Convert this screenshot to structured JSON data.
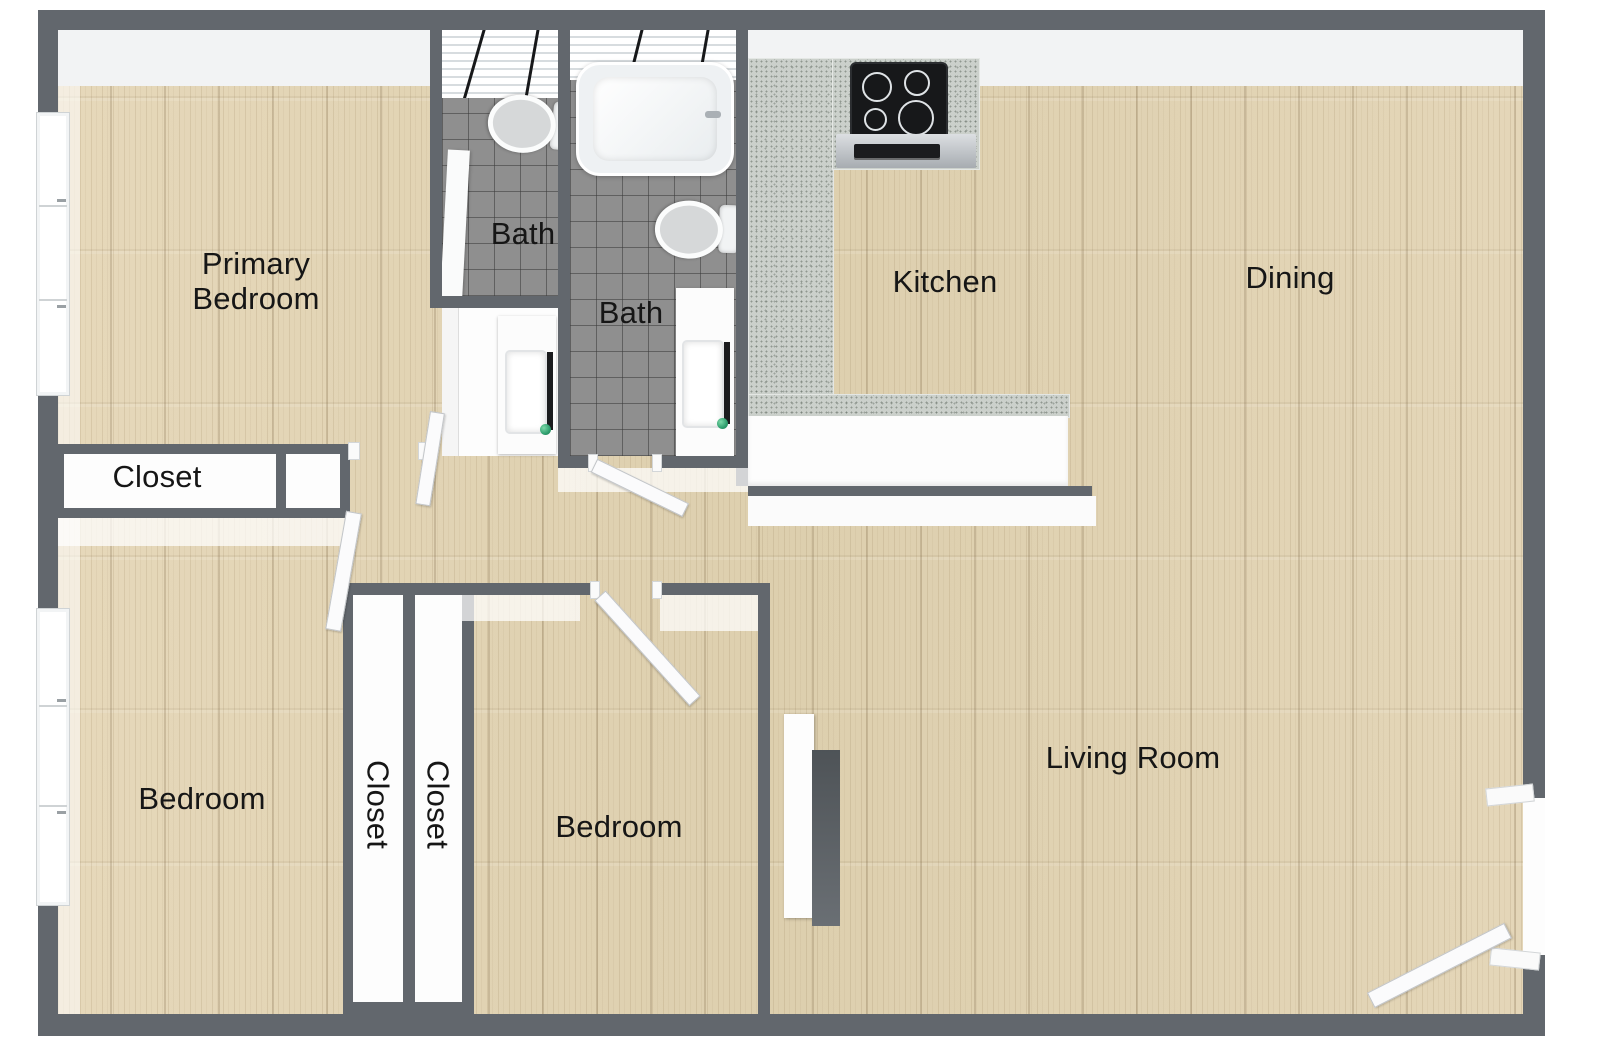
{
  "floor_plan": {
    "rooms": {
      "primary_bedroom": {
        "label": "Primary Bedroom"
      },
      "bath_small": {
        "label": "Bath"
      },
      "bath_large": {
        "label": "Bath"
      },
      "kitchen": {
        "label": "Kitchen"
      },
      "dining": {
        "label": "Dining"
      },
      "hall_closet": {
        "label": "Closet"
      },
      "bedroom_left": {
        "label": "Bedroom"
      },
      "closet_left": {
        "label": "Closet"
      },
      "closet_right": {
        "label": "Closet"
      },
      "bedroom_middle": {
        "label": "Bedroom"
      },
      "living_room": {
        "label": "Living Room"
      }
    },
    "colors": {
      "outer_wall": "#62676d",
      "inner_wall_face": "#f2f3f4",
      "wood_floor": "#e2d4b5",
      "tile_floor": "#8f8f8f",
      "counter_speckle": "#cbd0cb",
      "fixture_white": "#fbfcfc",
      "cooktop_black": "#17181a",
      "fireplace_panel": "#565b60",
      "faucet_accent_green": "#2f9e6e",
      "label_text": "#161616"
    },
    "fixtures": {
      "bath_small": [
        "toilet",
        "shower-panel",
        "vanity-sink"
      ],
      "bath_large": [
        "bathtub",
        "toilet",
        "vanity-sink"
      ],
      "kitchen": [
        "cooktop",
        "oven",
        "l-counter",
        "peninsula-counter"
      ],
      "living_room": [
        "fireplace-panel"
      ],
      "windows": [
        "primary-bedroom-window",
        "bedroom-left-window"
      ],
      "doors": [
        "primary-bedroom-door",
        "bath-small-door",
        "bath-large-door",
        "bedroom-middle-door",
        "entry-door"
      ]
    }
  }
}
